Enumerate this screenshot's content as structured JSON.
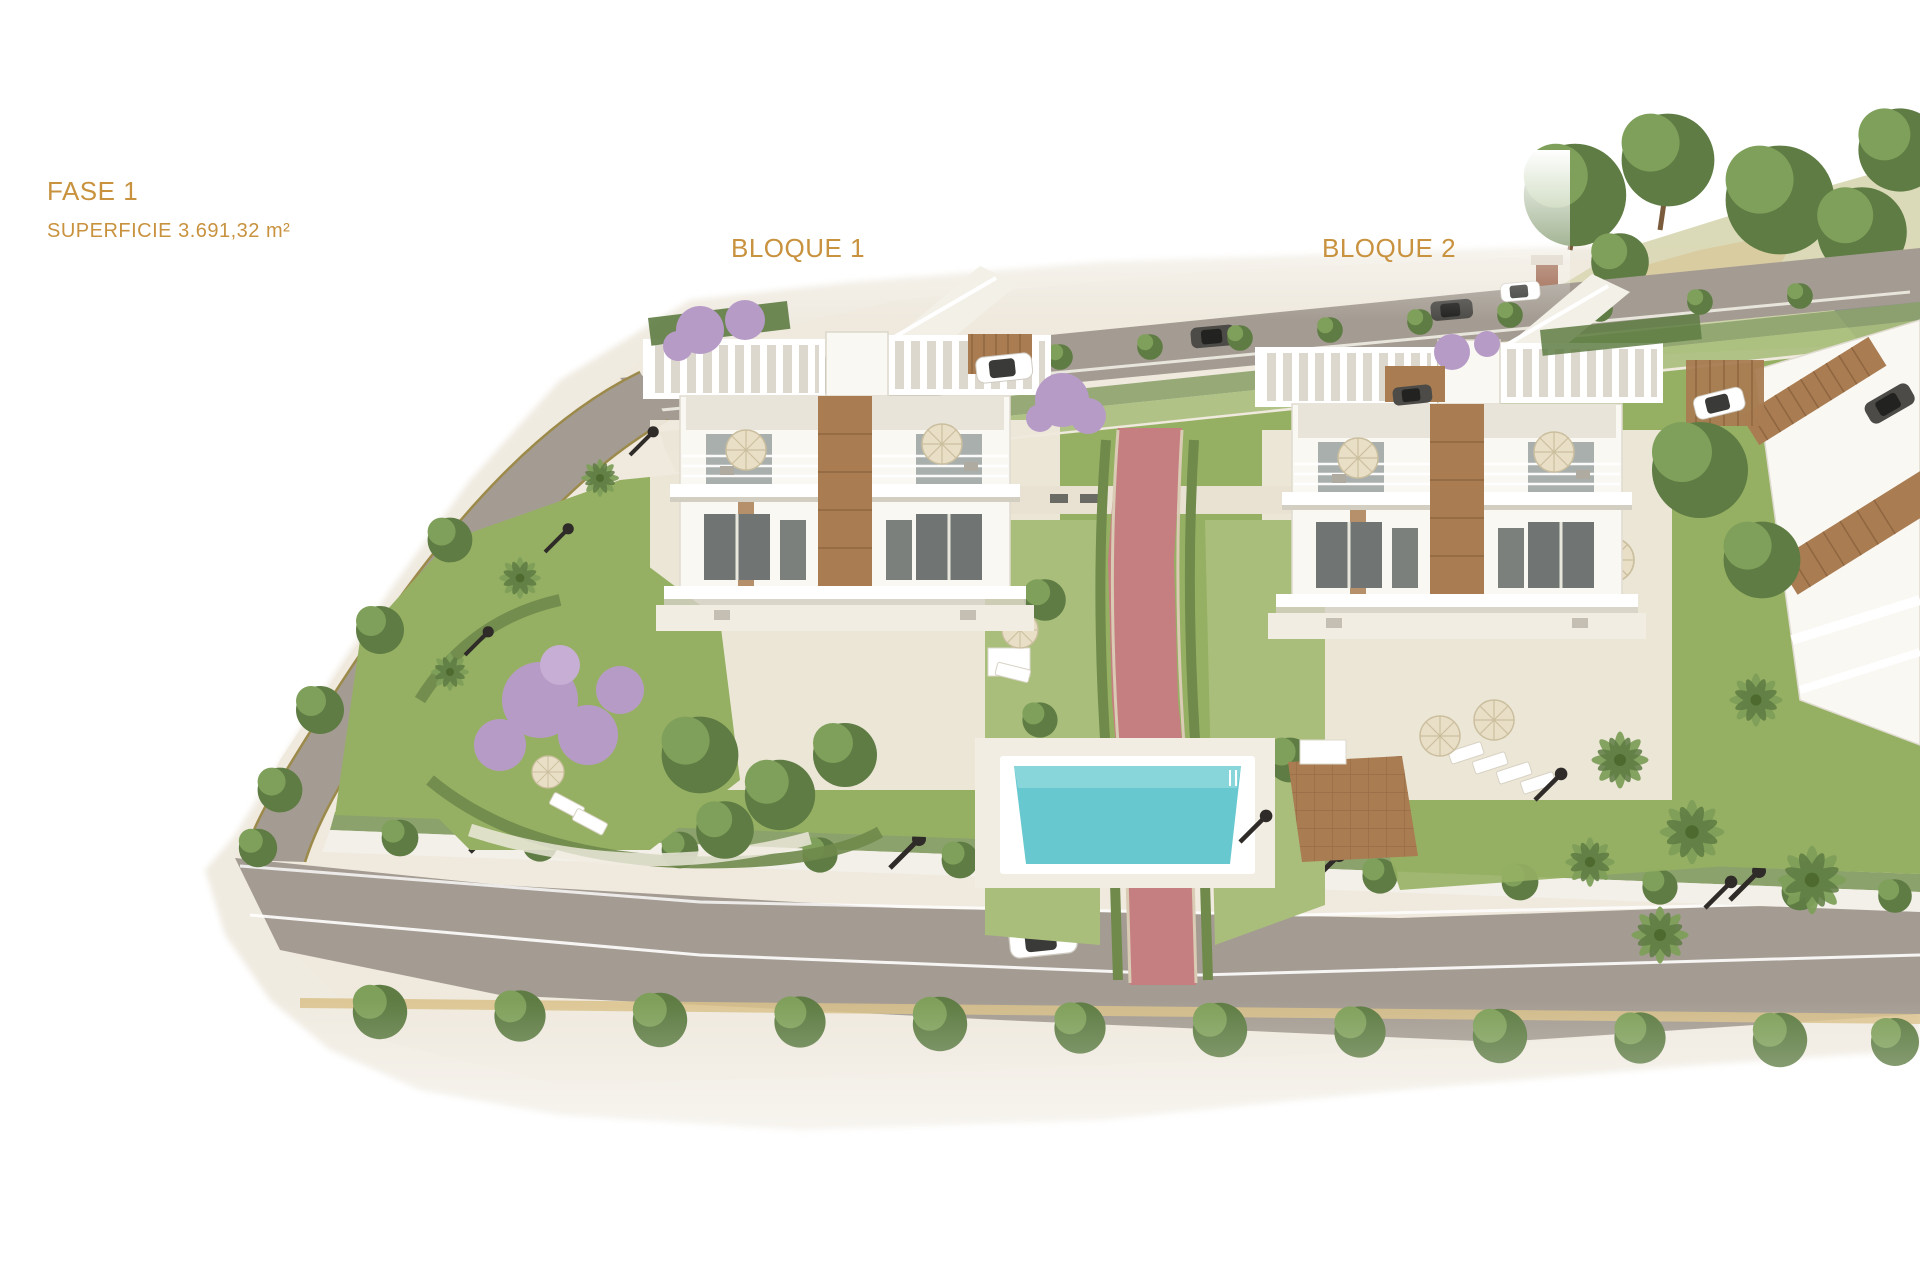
{
  "labels": {
    "phase": "FASE 1",
    "area": "SUPERFICIE 3.691,32 m²",
    "block1": "BLOQUE 1",
    "block2": "BLOQUE 2"
  },
  "colors": {
    "label_text": "#C8923F",
    "ground": "#EFE9DE",
    "road": "#A49C92",
    "grass": "#96B063",
    "grass_light": "#A9BE7B",
    "hedge": "#8CA26C",
    "tree_dark": "#5E7C43",
    "tree_mid": "#7FA05A",
    "pool_water": "#68C8D0",
    "pool_deck": "#F2EDE2",
    "path_pink": "#C67F80",
    "wood": "#A97C52",
    "building": "#FAF8F3",
    "jacaranda": "#B79BC7",
    "umbrella": "#E9DFC6",
    "car_dark": "#4C4B47"
  }
}
